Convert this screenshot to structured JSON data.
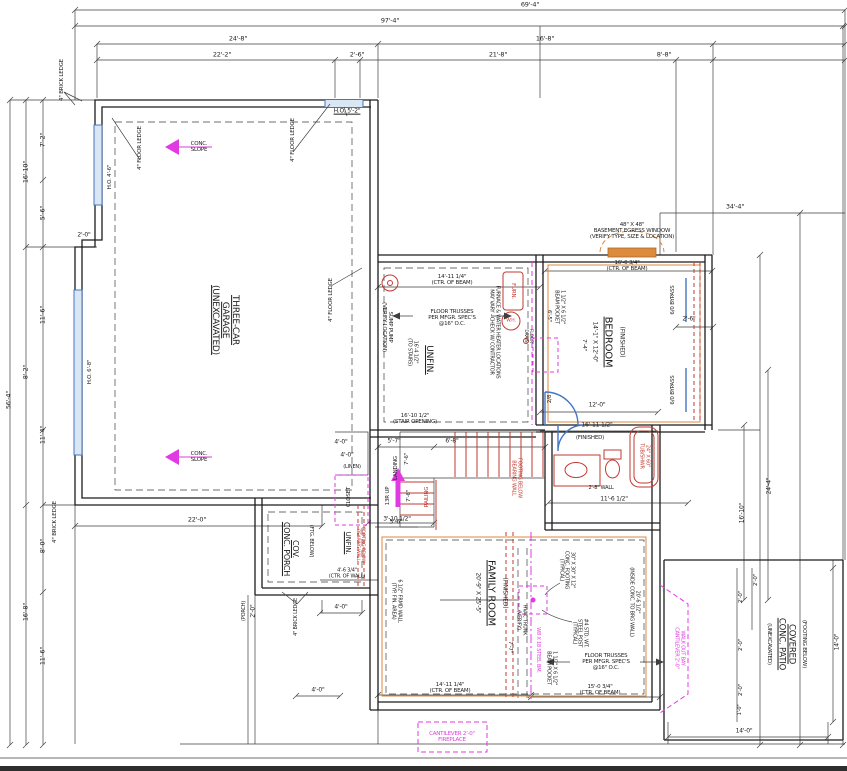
{
  "palette": {
    "line": "#3f3f3f",
    "wall": "#1c1c1c",
    "red": "#c23b32",
    "orange": "#dd8a3c",
    "magenta": "#e23ae2",
    "blue": "#4576c2",
    "window_fill": "#d9e6f4"
  },
  "labels": [
    {
      "name": "dim-top-overall",
      "text": "69'-4\"",
      "x": 530,
      "y": 5,
      "s": 6.5
    },
    {
      "name": "dim-top-97-4",
      "text": "97'-4\"",
      "x": 390,
      "y": 21,
      "s": 6.5
    },
    {
      "name": "dim-top-24-8",
      "text": "24'-8\"",
      "x": 238,
      "y": 39,
      "s": 6.5
    },
    {
      "name": "dim-top-16-8",
      "text": "16'-8\"",
      "x": 545,
      "y": 39,
      "s": 6.5
    },
    {
      "name": "dim-top-22-2",
      "text": "22'-2\"",
      "x": 222,
      "y": 55,
      "s": 6.5
    },
    {
      "name": "dim-top-2-6",
      "text": "2'-6\"",
      "x": 357,
      "y": 55,
      "s": 6.5
    },
    {
      "name": "dim-top-21-8",
      "text": "21'-8\"",
      "x": 498,
      "y": 55,
      "s": 6.5
    },
    {
      "name": "dim-top-8-8",
      "text": "8'-8\"",
      "x": 664,
      "y": 55,
      "s": 6.5
    },
    {
      "name": "dim-right-34-4",
      "text": "34'-4\"",
      "x": 735,
      "y": 207,
      "s": 6.5
    },
    {
      "name": "dim-left-7-2",
      "text": "7'-2\"",
      "x": 43,
      "y": 140,
      "r": -90,
      "s": 6.5
    },
    {
      "name": "dim-left-16-10",
      "text": "16'-10\"",
      "x": 26,
      "y": 172,
      "r": -90,
      "s": 6.5
    },
    {
      "name": "dim-left-5-6",
      "text": "5'-6\"",
      "x": 43,
      "y": 213,
      "r": -90,
      "s": 6.5
    },
    {
      "name": "dim-left-2-0",
      "text": "2'-0\"",
      "x": 84,
      "y": 236,
      "s": 6
    },
    {
      "name": "dim-left-11-6",
      "text": "11'-6\"",
      "x": 43,
      "y": 315,
      "r": -90,
      "s": 6.5
    },
    {
      "name": "dim-left-8-2",
      "text": "8'-2\"",
      "x": 26,
      "y": 372,
      "r": -90,
      "s": 6.5
    },
    {
      "name": "dim-left-56-4",
      "text": "56'-4\"",
      "x": 9,
      "y": 400,
      "r": -90,
      "s": 6.5
    },
    {
      "name": "dim-left-11-4",
      "text": "11'-4\"",
      "x": 43,
      "y": 435,
      "r": -90,
      "s": 6.5
    },
    {
      "name": "dim-left-8-0",
      "text": "8'-0\"",
      "x": 43,
      "y": 546,
      "r": -90,
      "s": 6.5
    },
    {
      "name": "dim-left-16-8",
      "text": "16'-8\"",
      "x": 26,
      "y": 612,
      "r": -90,
      "s": 6.5
    },
    {
      "name": "dim-left-11-6b",
      "text": "11'-6\"",
      "x": 43,
      "y": 656,
      "r": -90,
      "s": 6.5
    },
    {
      "name": "note-brick-ledge-tl",
      "text": "4\" BRICK LEDGE",
      "x": 62,
      "y": 80,
      "r": -90,
      "s": 5.5
    },
    {
      "name": "note-floor-ledge-1",
      "text": "4\" FLOOR LEDGE",
      "x": 140,
      "y": 148,
      "r": -90,
      "s": 5.5
    },
    {
      "name": "note-floor-ledge-2",
      "text": "4\" FLOOR LEDGE",
      "x": 293,
      "y": 140,
      "r": -90,
      "s": 5.5
    },
    {
      "name": "note-ho-5-2",
      "text": "H.O. 5'-2\"",
      "x": 347,
      "y": 112,
      "s": 6,
      "u": 1
    },
    {
      "name": "note-conc-slope-1",
      "text": "CONC.\nSLOPE",
      "x": 199,
      "y": 147,
      "s": 5.5
    },
    {
      "name": "room-garage",
      "text": "THREE-CAR\nGARAGE\n(UNEXCAVATED)",
      "x": 225,
      "y": 320,
      "r": 90,
      "s": 9,
      "u": 1
    },
    {
      "name": "note-floor-ledge-3",
      "text": "4\" FLOOR LEDGE",
      "x": 331,
      "y": 300,
      "r": -90,
      "s": 5.5
    },
    {
      "name": "note-conc-slope-2",
      "text": "CONC.\nSLOPE",
      "x": 199,
      "y": 457,
      "s": 5.5
    },
    {
      "name": "note-ho-4-6",
      "text": "H.O. 4'-6\"",
      "x": 110,
      "y": 177,
      "r": -90,
      "s": 5.5
    },
    {
      "name": "note-ho-6-8",
      "text": "H.O. 6'-8\"",
      "x": 90,
      "y": 372,
      "r": -90,
      "s": 5.5
    },
    {
      "name": "note-brick-ledge-bl",
      "text": "4\" BRICK LEDGE",
      "x": 55,
      "y": 522,
      "r": -90,
      "s": 5.5
    },
    {
      "name": "dim-garage-22-0",
      "text": "22'-0\"",
      "x": 197,
      "y": 520,
      "s": 6.5
    },
    {
      "name": "note-sump",
      "text": "SUMP PUMP\n(VERIFY LOCATION)",
      "x": 387,
      "y": 327,
      "r": 90,
      "s": 5.5
    },
    {
      "name": "dim-beam-14-11-top",
      "text": "14'-11 1/4\"\n(CTR. OF BEAM)",
      "x": 452,
      "y": 280,
      "s": 5.5
    },
    {
      "name": "note-trusses-1",
      "text": "FLOOR TRUSSES\nPER MFGR. SPEC'S\n@16\" O.C.",
      "x": 452,
      "y": 318,
      "s": 5.5
    },
    {
      "name": "room-unfin-1",
      "text": "UNFIN.",
      "x": 429,
      "y": 360,
      "r": 90,
      "s": 9,
      "u": 1
    },
    {
      "name": "dim-to-stairs",
      "text": "16'-4 1/2\"\n(TO STAIRS)",
      "x": 412,
      "y": 352,
      "r": 90,
      "s": 5
    },
    {
      "name": "note-furnace-wh",
      "text": "FURNACE & WATER HEATER LOCATIONS\nMAY VARY - CHECK W/ CONTRACTOR",
      "x": 494,
      "y": 332,
      "r": 90,
      "s": 5
    },
    {
      "name": "label-furn",
      "text": "FURN.",
      "x": 513,
      "y": 291,
      "r": 90,
      "s": 5.5,
      "c": "r"
    },
    {
      "name": "label-wh",
      "text": "W.H.",
      "x": 511,
      "y": 321,
      "s": 4.5,
      "c": "r"
    },
    {
      "name": "label-floor-drain",
      "text": "FLOOR\nDRAIN",
      "x": 528,
      "y": 336,
      "r": 90,
      "s": 4.5
    },
    {
      "name": "dim-beam-16-0",
      "text": "16'-0 3/4\"\n(CTR. OF BEAM)",
      "x": 627,
      "y": 266,
      "s": 5.5
    },
    {
      "name": "dim-stair-opening",
      "text": "16'-10 1/2\"\n(STAIR OPENING)",
      "x": 415,
      "y": 419,
      "s": 5.5
    },
    {
      "name": "dim-5-7",
      "text": "5'-7\"",
      "x": 394,
      "y": 442,
      "s": 6
    },
    {
      "name": "dim-6-8",
      "text": "6'-8\"",
      "x": 452,
      "y": 442,
      "s": 6
    },
    {
      "name": "dim-7-6-a",
      "text": "7'-6\"",
      "x": 407,
      "y": 459,
      "r": -90,
      "s": 5.5
    },
    {
      "name": "label-landing",
      "text": "LANDING",
      "x": 396,
      "y": 468,
      "r": -90,
      "s": 5.5
    },
    {
      "name": "label-13r-up",
      "text": "13R UP",
      "x": 388,
      "y": 496,
      "r": -90,
      "s": 5.5
    },
    {
      "name": "dim-7-6-b",
      "text": "7'-6\"",
      "x": 409,
      "y": 496,
      "r": -90,
      "s": 5.5
    },
    {
      "name": "label-railing",
      "text": "RAILING",
      "x": 427,
      "y": 497,
      "r": -90,
      "s": 5.5,
      "c": "r"
    },
    {
      "name": "dim-3-10",
      "text": "3'-10 1/2\"",
      "x": 397,
      "y": 520,
      "s": 6
    },
    {
      "name": "dim-4-0-a",
      "text": "4'-0\"",
      "x": 341,
      "y": 443,
      "s": 6
    },
    {
      "name": "dim-4-0-b",
      "text": "4'-0\"",
      "x": 347,
      "y": 456,
      "s": 6
    },
    {
      "name": "label-linen",
      "text": "(LINEN)",
      "x": 352,
      "y": 468,
      "s": 5
    },
    {
      "name": "label-closet",
      "text": "CLOSET",
      "x": 349,
      "y": 497,
      "r": -90,
      "s": 5.5
    },
    {
      "name": "note-footing-bearing-1",
      "text": "FOOTING BELOW\nBEARING WALL",
      "x": 516,
      "y": 478,
      "r": 90,
      "s": 5,
      "c": "r"
    },
    {
      "name": "note-egress",
      "text": "48\" X 48\"\nBASEMENT EGRESS WINDOW\n(VERIFY TYPE, SIZE & LOCATION)",
      "x": 632,
      "y": 231,
      "s": 5.5
    },
    {
      "name": "dim-bedroom-size",
      "text": "14'-1\" X 12'-0\"",
      "x": 594,
      "y": 342,
      "r": 90,
      "s": 6
    },
    {
      "name": "room-bedroom",
      "text": "BEDROOM",
      "x": 608,
      "y": 342,
      "r": 90,
      "s": 10,
      "u": 1
    },
    {
      "name": "label-bedroom-finished",
      "text": "(FINISHED)",
      "x": 621,
      "y": 342,
      "r": 90,
      "s": 6
    },
    {
      "name": "label-bypass-1",
      "text": "6/0 BYPASS",
      "x": 673,
      "y": 300,
      "r": -90,
      "s": 5.5
    },
    {
      "name": "label-bypass-2",
      "text": "6/0 BYPASS",
      "x": 673,
      "y": 390,
      "r": -90,
      "s": 5.5
    },
    {
      "name": "dim-2-6-closet",
      "text": "2'-6\"",
      "x": 689,
      "y": 320,
      "s": 6
    },
    {
      "name": "dim-12-0",
      "text": "12'-0\"",
      "x": 597,
      "y": 406,
      "s": 6
    },
    {
      "name": "dim-16-11",
      "text": "16'-11 1/2\"",
      "x": 597,
      "y": 426,
      "s": 6
    },
    {
      "name": "note-beam-pocket-1",
      "text": "1 1/2\" X 6 1/2\"\nBEAM POCKET",
      "x": 559,
      "y": 307,
      "r": 90,
      "s": 5
    },
    {
      "name": "dim-6-5",
      "text": "6'-5\"",
      "x": 549,
      "y": 316,
      "r": 90,
      "s": 5.5
    },
    {
      "name": "dim-7-4",
      "text": "7'-4\"",
      "x": 584,
      "y": 345,
      "r": 90,
      "s": 5.5
    },
    {
      "name": "label-door-2-8",
      "text": "2/8",
      "x": 550,
      "y": 399,
      "r": -90,
      "s": 5.5
    },
    {
      "name": "label-finished-hall",
      "text": "(FINISHED)",
      "x": 590,
      "y": 438,
      "s": 5.5
    },
    {
      "name": "label-tub",
      "text": "24\" X 60\"\nTUB/SHWR",
      "x": 644,
      "y": 456,
      "r": 90,
      "s": 5,
      "c": "r"
    },
    {
      "name": "note-2-8-wall",
      "text": "2'-8\" WALL",
      "x": 601,
      "y": 489,
      "s": 5
    },
    {
      "name": "dim-11-6-half",
      "text": "11'-6 1/2\"",
      "x": 614,
      "y": 500,
      "s": 6
    },
    {
      "name": "dim-family-size",
      "text": "20'-9\" X 25'-5\"",
      "x": 477,
      "y": 593,
      "r": 90,
      "s": 6
    },
    {
      "name": "room-family",
      "text": "FAMILY ROOM",
      "x": 491,
      "y": 593,
      "r": 90,
      "s": 10,
      "u": 1
    },
    {
      "name": "label-family-finished",
      "text": "(FINISHED)",
      "x": 504,
      "y": 593,
      "r": 90,
      "s": 6
    },
    {
      "name": "note-conc-footing",
      "text": "30\" X 30\" X 12\"\nCONC. FOOTING\n(TYPICAL)",
      "x": 566,
      "y": 570,
      "r": 90,
      "s": 5
    },
    {
      "name": "note-steel-post",
      "text": "#4 STD. WT.\nSTEEL POST\n(TYPICAL)",
      "x": 579,
      "y": 633,
      "r": 90,
      "s": 5
    },
    {
      "name": "note-beam-pocket-2",
      "text": "1 1/2\" X 6 1/2\"\nBEAM POCKET",
      "x": 551,
      "y": 668,
      "r": 90,
      "s": 5
    },
    {
      "name": "label-steel-beam",
      "text": "W8 X 18 STEEL BM.",
      "x": 537,
      "y": 650,
      "r": 90,
      "s": 5,
      "c": "m"
    },
    {
      "name": "label-hvac",
      "text": "HVAC TRUNK\n(VERIFY)",
      "x": 521,
      "y": 620,
      "r": 90,
      "s": 5
    },
    {
      "name": "dim-7-7",
      "text": "7'-7\"",
      "x": 510,
      "y": 647,
      "r": 90,
      "s": 5.5
    },
    {
      "name": "note-trusses-2",
      "text": "FLOOR TRUSSES\nPER MFGR. SPEC'S\n@16\" O.C.",
      "x": 606,
      "y": 662,
      "s": 5.5
    },
    {
      "name": "dim-beam-14-11-bot",
      "text": "14'-11 1/4\"\n(CTR. OF BEAM)",
      "x": 450,
      "y": 688,
      "s": 5.5
    },
    {
      "name": "dim-beam-15-0",
      "text": "15'-0 3/4\"\n(CTR. OF BEAM)",
      "x": 600,
      "y": 690,
      "s": 5.5
    },
    {
      "name": "note-frmd-wall",
      "text": "6 1/2\" FRMD WALL\n(TYP. FIN. AREA)",
      "x": 396,
      "y": 601,
      "r": 90,
      "s": 5
    },
    {
      "name": "dim-20-6",
      "text": "20'-6 1/2\"\n(INSIDE CONC. TO BRG WALL)",
      "x": 634,
      "y": 602,
      "r": 90,
      "s": 5
    },
    {
      "name": "room-porch",
      "text": "COV.\nCONC. PORCH",
      "x": 290,
      "y": 549,
      "r": 90,
      "s": 8,
      "u": 1
    },
    {
      "name": "label-porch-ftg",
      "text": "(FTG. BELOW)",
      "x": 310,
      "y": 541,
      "r": 90,
      "s": 5
    },
    {
      "name": "room-unfin-2",
      "text": "UNFIN.",
      "x": 347,
      "y": 543,
      "r": 90,
      "s": 7,
      "u": 1
    },
    {
      "name": "note-footing-bearing-2",
      "text": "FOOTING BELOW\nBEARING WALL",
      "x": 360,
      "y": 545,
      "r": 90,
      "s": 4.5,
      "c": "r"
    },
    {
      "name": "dim-4-6-wall",
      "text": "4'-6 3/4\"\n(CTR. OF WALL)",
      "x": 347,
      "y": 574,
      "s": 5
    },
    {
      "name": "dim-5-6-porch",
      "text": "5'-6\"",
      "x": 396,
      "y": 523,
      "s": 6
    },
    {
      "name": "note-brick-ledge-porch",
      "text": "4\" BRICK LEDGE",
      "x": 297,
      "y": 617,
      "r": -90,
      "s": 5
    },
    {
      "name": "label-porch-dim",
      "text": "(PORCH)",
      "x": 245,
      "y": 611,
      "r": -90,
      "s": 5
    },
    {
      "name": "dim-2-0-porch",
      "text": "2'-0\"",
      "x": 254,
      "y": 611,
      "r": -90,
      "s": 6
    },
    {
      "name": "dim-4-0-porch",
      "text": "4'-0\"",
      "x": 341,
      "y": 608,
      "s": 6
    },
    {
      "name": "dim-4-0-bot",
      "text": "4'-0\"",
      "x": 318,
      "y": 691,
      "s": 6
    },
    {
      "name": "label-patio-footing",
      "text": "(FOOTING BELOW)",
      "x": 804,
      "y": 644,
      "r": 90,
      "s": 5.5
    },
    {
      "name": "room-patio",
      "text": "COVERED\nCONC. PATIO",
      "x": 786,
      "y": 644,
      "r": 90,
      "s": 8.5,
      "u": 1
    },
    {
      "name": "label-patio-unexc",
      "text": "(UNEXCAVATED)",
      "x": 769,
      "y": 644,
      "r": 90,
      "s": 5.5
    },
    {
      "name": "note-walkout",
      "text": "WALK OUT BAY\nCANTILEVER 2'-0\"",
      "x": 679,
      "y": 648,
      "r": 90,
      "s": 5,
      "c": "m"
    },
    {
      "name": "dim-patio-2-0-a",
      "text": "2'-0\"",
      "x": 741,
      "y": 597,
      "r": -90,
      "s": 5.5
    },
    {
      "name": "dim-patio-2-0-b",
      "text": "2'-0\"",
      "x": 741,
      "y": 645,
      "r": -90,
      "s": 5.5
    },
    {
      "name": "dim-patio-2-0-c",
      "text": "2'-0\"",
      "x": 741,
      "y": 690,
      "r": -90,
      "s": 5.5
    },
    {
      "name": "dim-patio-1-0",
      "text": "1'-0\"",
      "x": 741,
      "y": 710,
      "r": -90,
      "s": 5
    },
    {
      "name": "dim-patio-2-0-d",
      "text": "2'-0\"",
      "x": 756,
      "y": 580,
      "r": -90,
      "s": 5.5
    },
    {
      "name": "dim-patio-14-0-r",
      "text": "14'-0\"",
      "x": 838,
      "y": 642,
      "r": -90,
      "s": 6
    },
    {
      "name": "dim-patio-14-0-b",
      "text": "14'-0\"",
      "x": 744,
      "y": 732,
      "s": 6
    },
    {
      "name": "dim-right-16-10",
      "text": "16'-10\"",
      "x": 743,
      "y": 513,
      "r": -90,
      "s": 6
    },
    {
      "name": "dim-right-24-4",
      "text": "24'-4\"",
      "x": 770,
      "y": 486,
      "r": -90,
      "s": 6
    },
    {
      "name": "note-fireplace",
      "text": "CANTILEVER 2'-0\"\nFIREPLACE",
      "x": 452,
      "y": 737,
      "s": 5.5,
      "c": "m"
    }
  ]
}
